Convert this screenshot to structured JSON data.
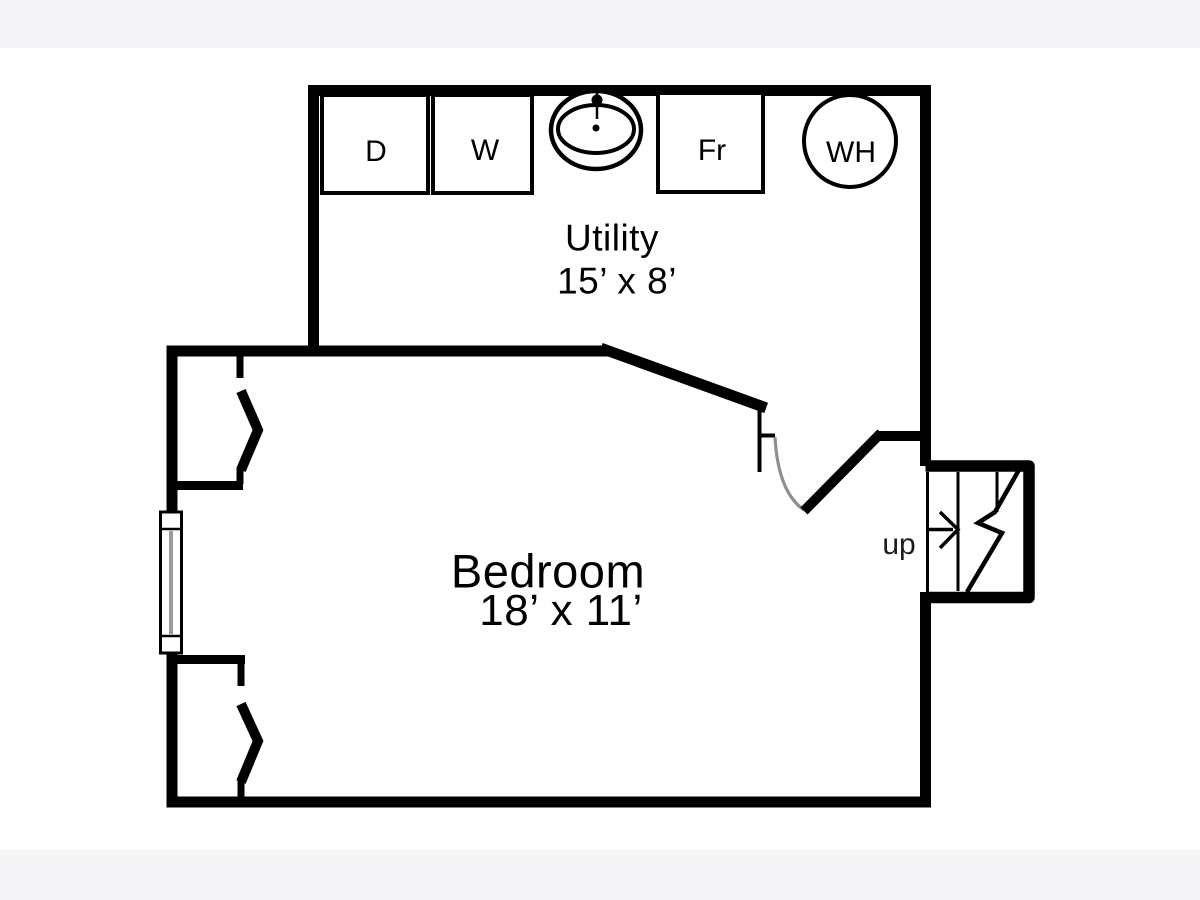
{
  "page": {
    "background_color": "#ffffff",
    "band_color": "#f5f4f6"
  },
  "plan": {
    "rooms": [
      {
        "id": "utility",
        "name": "Utility",
        "dimensions": "15’ x 8’"
      },
      {
        "id": "bedroom",
        "name": "Bedroom",
        "dimensions": "18’ x 11’"
      }
    ],
    "appliances": [
      {
        "id": "dryer",
        "label": "D"
      },
      {
        "id": "washer",
        "label": "W"
      },
      {
        "id": "laundry-tub",
        "label": ""
      },
      {
        "id": "freezer",
        "label": "Fr"
      },
      {
        "id": "water-heater",
        "label": "WH"
      }
    ],
    "stairs": {
      "direction_label": "up"
    },
    "colors": {
      "wall": "#000000",
      "door_swing": "#8f8f8f",
      "window_glass": "#9a9a9a"
    }
  }
}
